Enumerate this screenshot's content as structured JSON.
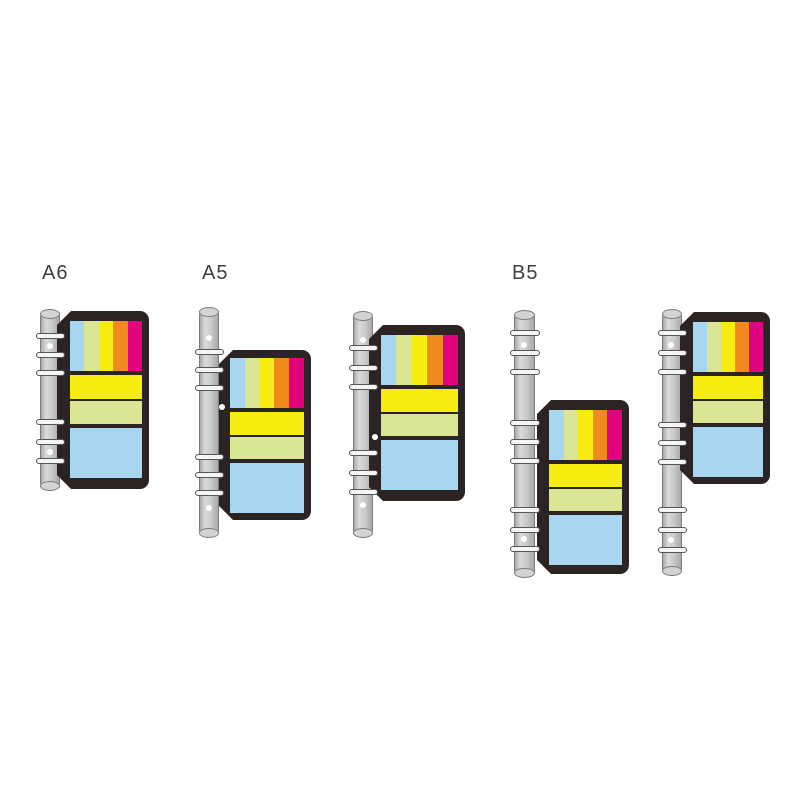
{
  "illustration": {
    "background": "#FFFFFF",
    "description": "Ring-binder spines with sticky-note and index-tab refill cards shown in three sizes"
  },
  "palette": {
    "card_shell": "#2B2422",
    "rod_fill_light": "#DADADA",
    "rod_fill_mid": "#C9C9C9",
    "rod_fill_dark": "#A9A9A9",
    "rod_cap_fill": "#D3D3D3",
    "rod_outline": "#7B7B7B",
    "ring_fill": "#F5F5F5",
    "ring_outline": "#565656",
    "hole_dot": "#FFFFFF",
    "label_text": "#3F3F3F"
  },
  "tab_colors": [
    {
      "name": "blue",
      "hex": "#A8D5F0"
    },
    {
      "name": "green",
      "hex": "#DAE694"
    },
    {
      "name": "yellow",
      "hex": "#F7EC0F"
    },
    {
      "name": "orange",
      "hex": "#F0891E"
    },
    {
      "name": "magenta",
      "hex": "#E2017E"
    }
  ],
  "units": [
    {
      "id": "a6",
      "label": "A6",
      "label_x": 42,
      "label_y": 272,
      "rod": {
        "x": 40,
        "y": 310,
        "w": 20,
        "h": 180
      },
      "rings_y": [
        336,
        355,
        373,
        422,
        442,
        461
      ],
      "dots": [
        {
          "x": 50,
          "y": 346
        },
        {
          "x": 50,
          "y": 452
        }
      ],
      "card": {
        "x": 57,
        "y": 311,
        "w": 92,
        "h": 178,
        "pad_l": 13,
        "pad_t": 10,
        "pad_r": 7
      },
      "blocks": [
        {
          "kind": "strips",
          "h": 50
        },
        {
          "kind": "gap",
          "h": 4
        },
        {
          "kind": "note",
          "color": "yellow",
          "h": 24
        },
        {
          "kind": "gap",
          "h": 2
        },
        {
          "kind": "note",
          "color": "green",
          "h": 23
        },
        {
          "kind": "gap",
          "h": 4
        },
        {
          "kind": "note",
          "color": "blue",
          "h": 50
        }
      ]
    },
    {
      "id": "a5",
      "label": "A5",
      "label_x": 202,
      "label_y": 272,
      "rod": {
        "x": 199,
        "y": 308,
        "w": 20,
        "h": 229
      },
      "rings_y": [
        352,
        370,
        388,
        457,
        475,
        493
      ],
      "dots": [
        {
          "x": 209,
          "y": 338
        },
        {
          "x": 222,
          "y": 407
        },
        {
          "x": 209,
          "y": 508
        }
      ],
      "card": {
        "x": 219,
        "y": 350,
        "w": 92,
        "h": 170,
        "pad_l": 11,
        "pad_t": 8,
        "pad_r": 7
      },
      "blocks": [
        {
          "kind": "strips",
          "h": 50
        },
        {
          "kind": "gap",
          "h": 4
        },
        {
          "kind": "note",
          "color": "yellow",
          "h": 23
        },
        {
          "kind": "gap",
          "h": 2
        },
        {
          "kind": "note",
          "color": "green",
          "h": 22
        },
        {
          "kind": "gap",
          "h": 4
        },
        {
          "kind": "note",
          "color": "blue",
          "h": 50
        }
      ]
    },
    {
      "id": "a5-alt",
      "label": "",
      "label_x": 0,
      "label_y": 0,
      "rod": {
        "x": 353,
        "y": 312,
        "w": 20,
        "h": 225
      },
      "rings_y": [
        348,
        368,
        387,
        453,
        473,
        492
      ],
      "dots": [
        {
          "x": 363,
          "y": 340
        },
        {
          "x": 375,
          "y": 437
        },
        {
          "x": 363,
          "y": 505
        }
      ],
      "card": {
        "x": 369,
        "y": 325,
        "w": 96,
        "h": 176,
        "pad_l": 12,
        "pad_t": 10,
        "pad_r": 7
      },
      "blocks": [
        {
          "kind": "strips",
          "h": 50
        },
        {
          "kind": "gap",
          "h": 4
        },
        {
          "kind": "note",
          "color": "yellow",
          "h": 23
        },
        {
          "kind": "gap",
          "h": 2
        },
        {
          "kind": "note",
          "color": "green",
          "h": 22
        },
        {
          "kind": "gap",
          "h": 4
        },
        {
          "kind": "note",
          "color": "blue",
          "h": 50
        }
      ]
    },
    {
      "id": "b5",
      "label": "B5",
      "label_x": 512,
      "label_y": 272,
      "rod": {
        "x": 514,
        "y": 311,
        "w": 21,
        "h": 266
      },
      "rings_y": [
        333,
        353,
        372,
        423,
        442,
        461,
        510,
        530,
        549
      ],
      "dots": [
        {
          "x": 524,
          "y": 345
        },
        {
          "x": 524,
          "y": 539
        }
      ],
      "card": {
        "x": 537,
        "y": 400,
        "w": 92,
        "h": 174,
        "pad_l": 12,
        "pad_t": 10,
        "pad_r": 7
      },
      "blocks": [
        {
          "kind": "strips",
          "h": 50
        },
        {
          "kind": "gap",
          "h": 4
        },
        {
          "kind": "note",
          "color": "yellow",
          "h": 23
        },
        {
          "kind": "gap",
          "h": 2
        },
        {
          "kind": "note",
          "color": "green",
          "h": 22
        },
        {
          "kind": "gap",
          "h": 4
        },
        {
          "kind": "note",
          "color": "blue",
          "h": 50
        }
      ]
    },
    {
      "id": "b5-alt",
      "label": "",
      "label_x": 0,
      "label_y": 0,
      "rod": {
        "x": 662,
        "y": 310,
        "w": 20,
        "h": 265
      },
      "rings_y": [
        333,
        353,
        372,
        425,
        443,
        462,
        510,
        530,
        550
      ],
      "dots": [
        {
          "x": 671,
          "y": 345
        },
        {
          "x": 671,
          "y": 540
        }
      ],
      "card": {
        "x": 680,
        "y": 312,
        "w": 90,
        "h": 172,
        "pad_l": 13,
        "pad_t": 10,
        "pad_r": 7
      },
      "blocks": [
        {
          "kind": "strips",
          "h": 50
        },
        {
          "kind": "gap",
          "h": 4
        },
        {
          "kind": "note",
          "color": "yellow",
          "h": 23
        },
        {
          "kind": "gap",
          "h": 2
        },
        {
          "kind": "note",
          "color": "green",
          "h": 22
        },
        {
          "kind": "gap",
          "h": 4
        },
        {
          "kind": "note",
          "color": "blue",
          "h": 50
        }
      ]
    }
  ]
}
